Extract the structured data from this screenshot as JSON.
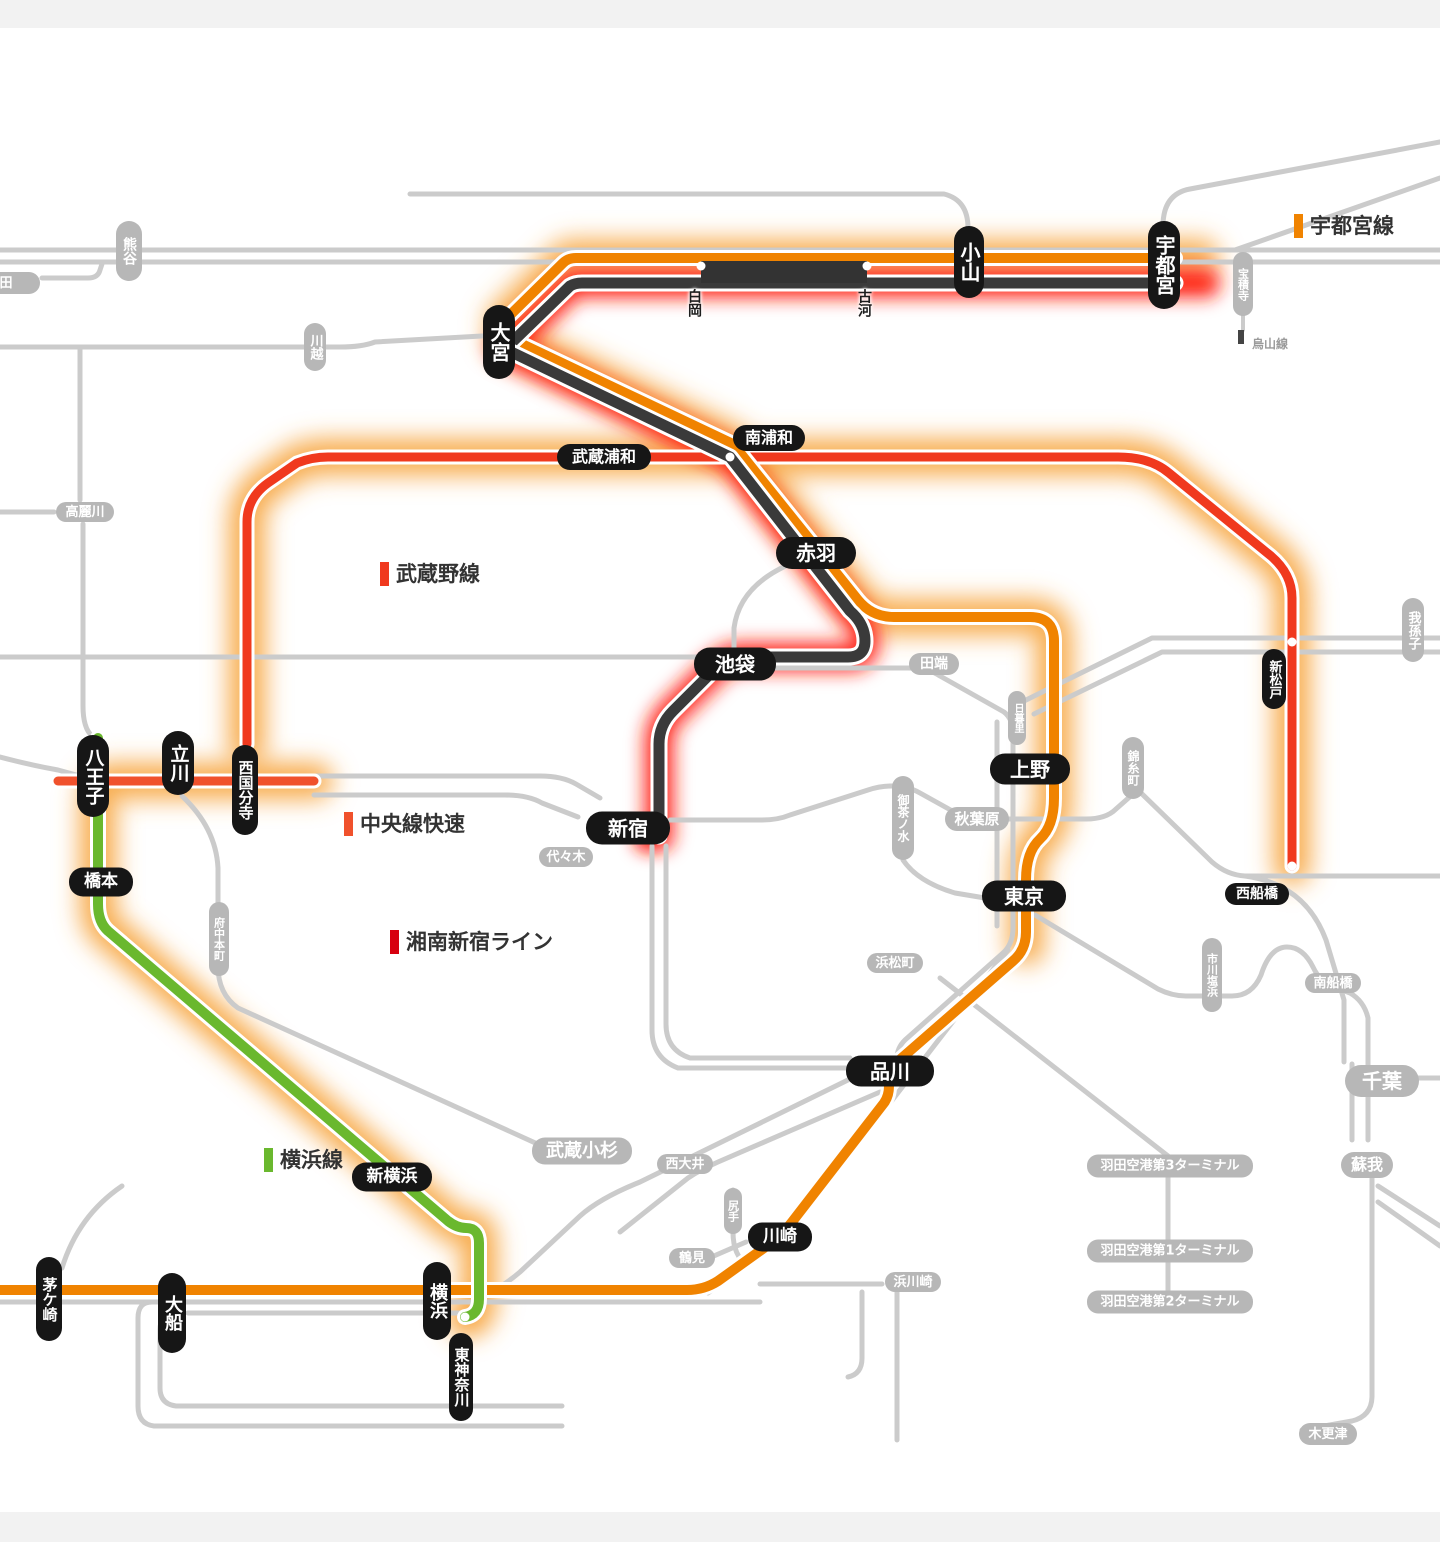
{
  "legends": [
    {
      "label": "宇都宮線",
      "color": "#f08300"
    },
    {
      "label": "武蔵野線",
      "color": "#f0391e"
    },
    {
      "label": "中央線快速",
      "color": "#f0512c"
    },
    {
      "label": "湘南新宿ライン",
      "color": "#d7000f"
    },
    {
      "label": "横浜線",
      "color": "#6ab82e"
    }
  ],
  "branch_label": {
    "label": "烏山線"
  },
  "stations_black": [
    {
      "name": "宇都宮"
    },
    {
      "name": "小山"
    },
    {
      "name": "大宮"
    },
    {
      "name": "南浦和"
    },
    {
      "name": "武蔵浦和"
    },
    {
      "name": "赤羽"
    },
    {
      "name": "池袋"
    },
    {
      "name": "新宿"
    },
    {
      "name": "上野"
    },
    {
      "name": "東京"
    },
    {
      "name": "品川"
    },
    {
      "name": "川崎"
    },
    {
      "name": "横浜"
    },
    {
      "name": "東神奈川"
    },
    {
      "name": "新横浜"
    },
    {
      "name": "橋本"
    },
    {
      "name": "八王子"
    },
    {
      "name": "立川"
    },
    {
      "name": "西国分寺"
    },
    {
      "name": "大船"
    },
    {
      "name": "茅ケ崎"
    },
    {
      "name": "新松戸"
    },
    {
      "name": "西船橋"
    }
  ],
  "stations_text": [
    {
      "name": "白岡"
    },
    {
      "name": "古河"
    }
  ],
  "stations_gray": [
    {
      "name": "熊谷"
    },
    {
      "name": "本庄早稲田"
    },
    {
      "name": "川越"
    },
    {
      "name": "高麗川"
    },
    {
      "name": "宝積寺"
    },
    {
      "name": "田端"
    },
    {
      "name": "日暮里"
    },
    {
      "name": "御茶ノ水"
    },
    {
      "name": "秋葉原"
    },
    {
      "name": "錦糸町"
    },
    {
      "name": "我孫子"
    },
    {
      "name": "代々木"
    },
    {
      "name": "浜松町"
    },
    {
      "name": "武蔵小杉"
    },
    {
      "name": "西大井"
    },
    {
      "name": "鶴見"
    },
    {
      "name": "尻手"
    },
    {
      "name": "浜川崎"
    },
    {
      "name": "府中本町"
    },
    {
      "name": "市川塩浜"
    },
    {
      "name": "南船橋"
    },
    {
      "name": "千葉"
    },
    {
      "name": "蘇我"
    },
    {
      "name": "木更津"
    },
    {
      "name": "羽田空港第3ターミナル"
    },
    {
      "name": "羽田空港第1ターミナル"
    },
    {
      "name": "羽田空港第2ターミナル"
    }
  ],
  "colors": {
    "orange_line": "#f08300",
    "vermilion_line": "#f0391e",
    "chuo_rapid_line": "#f0512c",
    "shonan_shinjuku_legend": "#d7000f",
    "yokohama_line": "#6ab82e",
    "suspended_dark_line": "#3a3a3a",
    "normal_gray_line": "#cbcbcb",
    "glow_delay": "#f7a43c",
    "glow_suspended": "#ff1e0f",
    "pill_black": "#161616",
    "pill_gray": "#b7b7b7"
  }
}
